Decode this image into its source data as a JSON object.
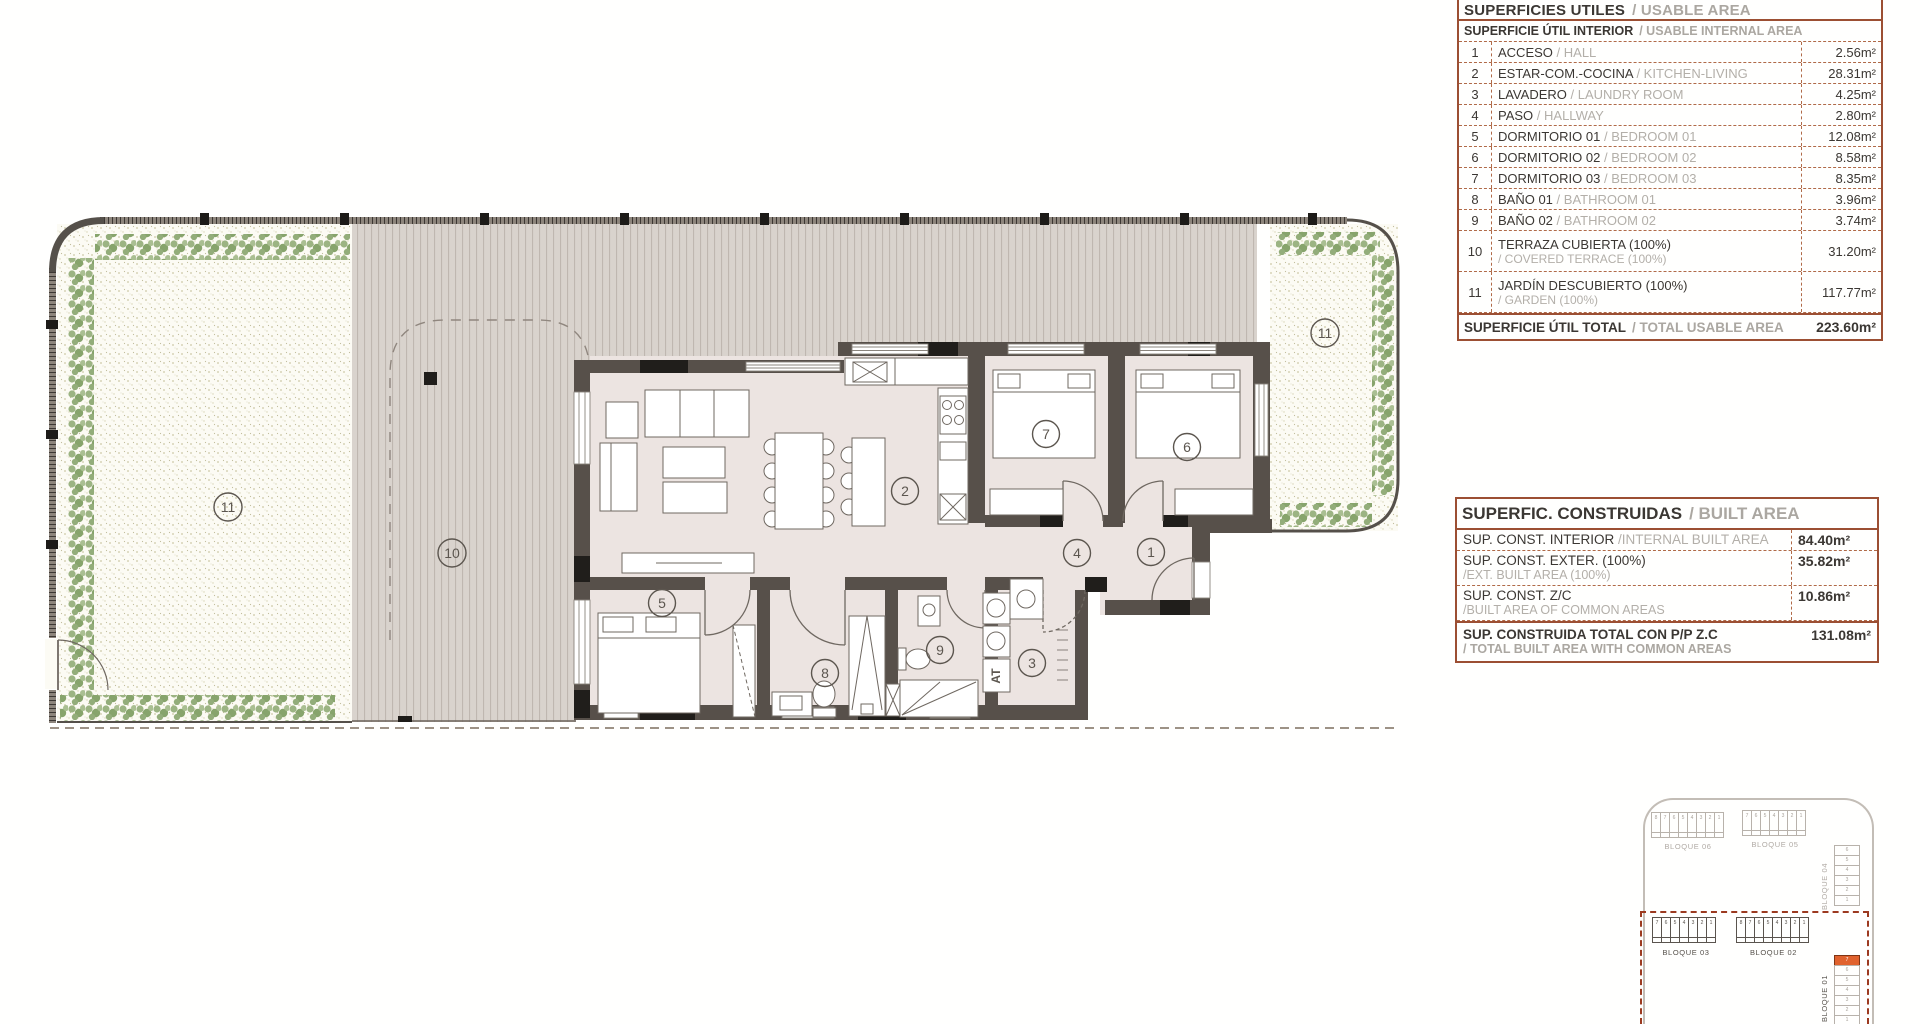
{
  "colors": {
    "table_border": "#9C4F33",
    "table_text": "#3B3733",
    "table_muted": "#ABA7A1",
    "wall": "#57504A",
    "wall_accent": "#201E1B",
    "floor": "#ECE4E1",
    "terrace_bg": "#D9D3CD",
    "terrace_stripe": "#BFB7B0",
    "garden_bg": "#FCFBF4",
    "garden_dot": "#CDC8A6",
    "shrub_green": "#96AE7C",
    "site_gray": "#B8B2AB",
    "site_dark": "#5A544E",
    "site_dashed_border": "#9C3A20",
    "unit_highlight": "#E0622E"
  },
  "plan": {
    "room_numbers": [
      "1",
      "2",
      "3",
      "4",
      "5",
      "6",
      "7",
      "8",
      "9",
      "10",
      "11"
    ],
    "at_label": "AT"
  },
  "usable_area_table": {
    "title": "SUPERFICIES UTILES",
    "title_en": "/ USABLE AREA",
    "subtitle": "SUPERFICIE ÚTIL INTERIOR",
    "subtitle_en": "/ USABLE INTERNAL AREA",
    "rows": [
      {
        "n": "1",
        "es": "ACCESO",
        "en": "/ HALL",
        "value": "2.56m²"
      },
      {
        "n": "2",
        "es": "ESTAR-COM.-COCINA",
        "en": "/ KITCHEN-LIVING",
        "value": "28.31m²"
      },
      {
        "n": "3",
        "es": "LAVADERO",
        "en": "/ LAUNDRY ROOM",
        "value": "4.25m²"
      },
      {
        "n": "4",
        "es": "PASO",
        "en": "/ HALLWAY",
        "value": "2.80m²"
      },
      {
        "n": "5",
        "es": "DORMITORIO 01",
        "en": "/ BEDROOM 01",
        "value": "12.08m²"
      },
      {
        "n": "6",
        "es": "DORMITORIO 02",
        "en": "/ BEDROOM 02",
        "value": "8.58m²"
      },
      {
        "n": "7",
        "es": "DORMITORIO 03",
        "en": "/ BEDROOM 03",
        "value": "8.35m²"
      },
      {
        "n": "8",
        "es": "BAÑO 01",
        "en": "/ BATHROOM 01",
        "value": "3.96m²"
      },
      {
        "n": "9",
        "es": "BAÑO 02",
        "en": "/ BATHROOM 02",
        "value": "3.74m²"
      },
      {
        "n": "10",
        "es": "TERRAZA CUBIERTA (100%)",
        "en": "/ COVERED TERRACE (100%)",
        "value": "31.20m²"
      },
      {
        "n": "11",
        "es": "JARDÍN DESCUBIERTO (100%)",
        "en": "/ GARDEN (100%)",
        "value": "117.77m²"
      }
    ],
    "total": "SUPERFICIE ÚTIL TOTAL",
    "total_en": "/ TOTAL USABLE AREA",
    "total_value": "223.60m²"
  },
  "built_area_table": {
    "title": "SUPERFIC. CONSTRUIDAS",
    "title_en": "/ BUILT AREA",
    "rows": [
      {
        "es": "SUP. CONST. INTERIOR",
        "en": "/INTERNAL BUILT AREA",
        "value": "84.40m²"
      },
      {
        "es": "SUP. CONST. EXTER. (100%)",
        "en": "/EXT. BUILT AREA (100%)",
        "value": "35.82m²"
      },
      {
        "es": "SUP. CONST. Z/C",
        "en": "/BUILT AREA OF COMMON AREAS",
        "value": "10.86m²"
      }
    ],
    "total": "SUP. CONSTRUIDA TOTAL CON P/P Z.C",
    "total_en": "/ TOTAL BUILT AREA WITH COMMON AREAS",
    "total_value": "131.08m²"
  },
  "site_plan": {
    "blocks": [
      {
        "name": "BLOQUE 06",
        "units": [
          "8",
          "7",
          "6",
          "5",
          "4",
          "3",
          "2",
          "1"
        ]
      },
      {
        "name": "BLOQUE 05",
        "units": [
          "7",
          "6",
          "5",
          "4",
          "3",
          "2",
          "1"
        ]
      },
      {
        "name": "BLOQUE 04",
        "units": [
          "6",
          "5",
          "4",
          "3",
          "2",
          "1"
        ]
      },
      {
        "name": "BLOQUE 03",
        "units": [
          "7",
          "6",
          "5",
          "4",
          "3",
          "2",
          "1"
        ]
      },
      {
        "name": "BLOQUE 02",
        "units": [
          "8",
          "7",
          "6",
          "5",
          "4",
          "3",
          "2",
          "1"
        ]
      },
      {
        "name": "BLOQUE 01",
        "units": [
          "7",
          "6",
          "5",
          "4",
          "3",
          "2",
          "1"
        ],
        "highlighted_unit": "7"
      }
    ]
  }
}
